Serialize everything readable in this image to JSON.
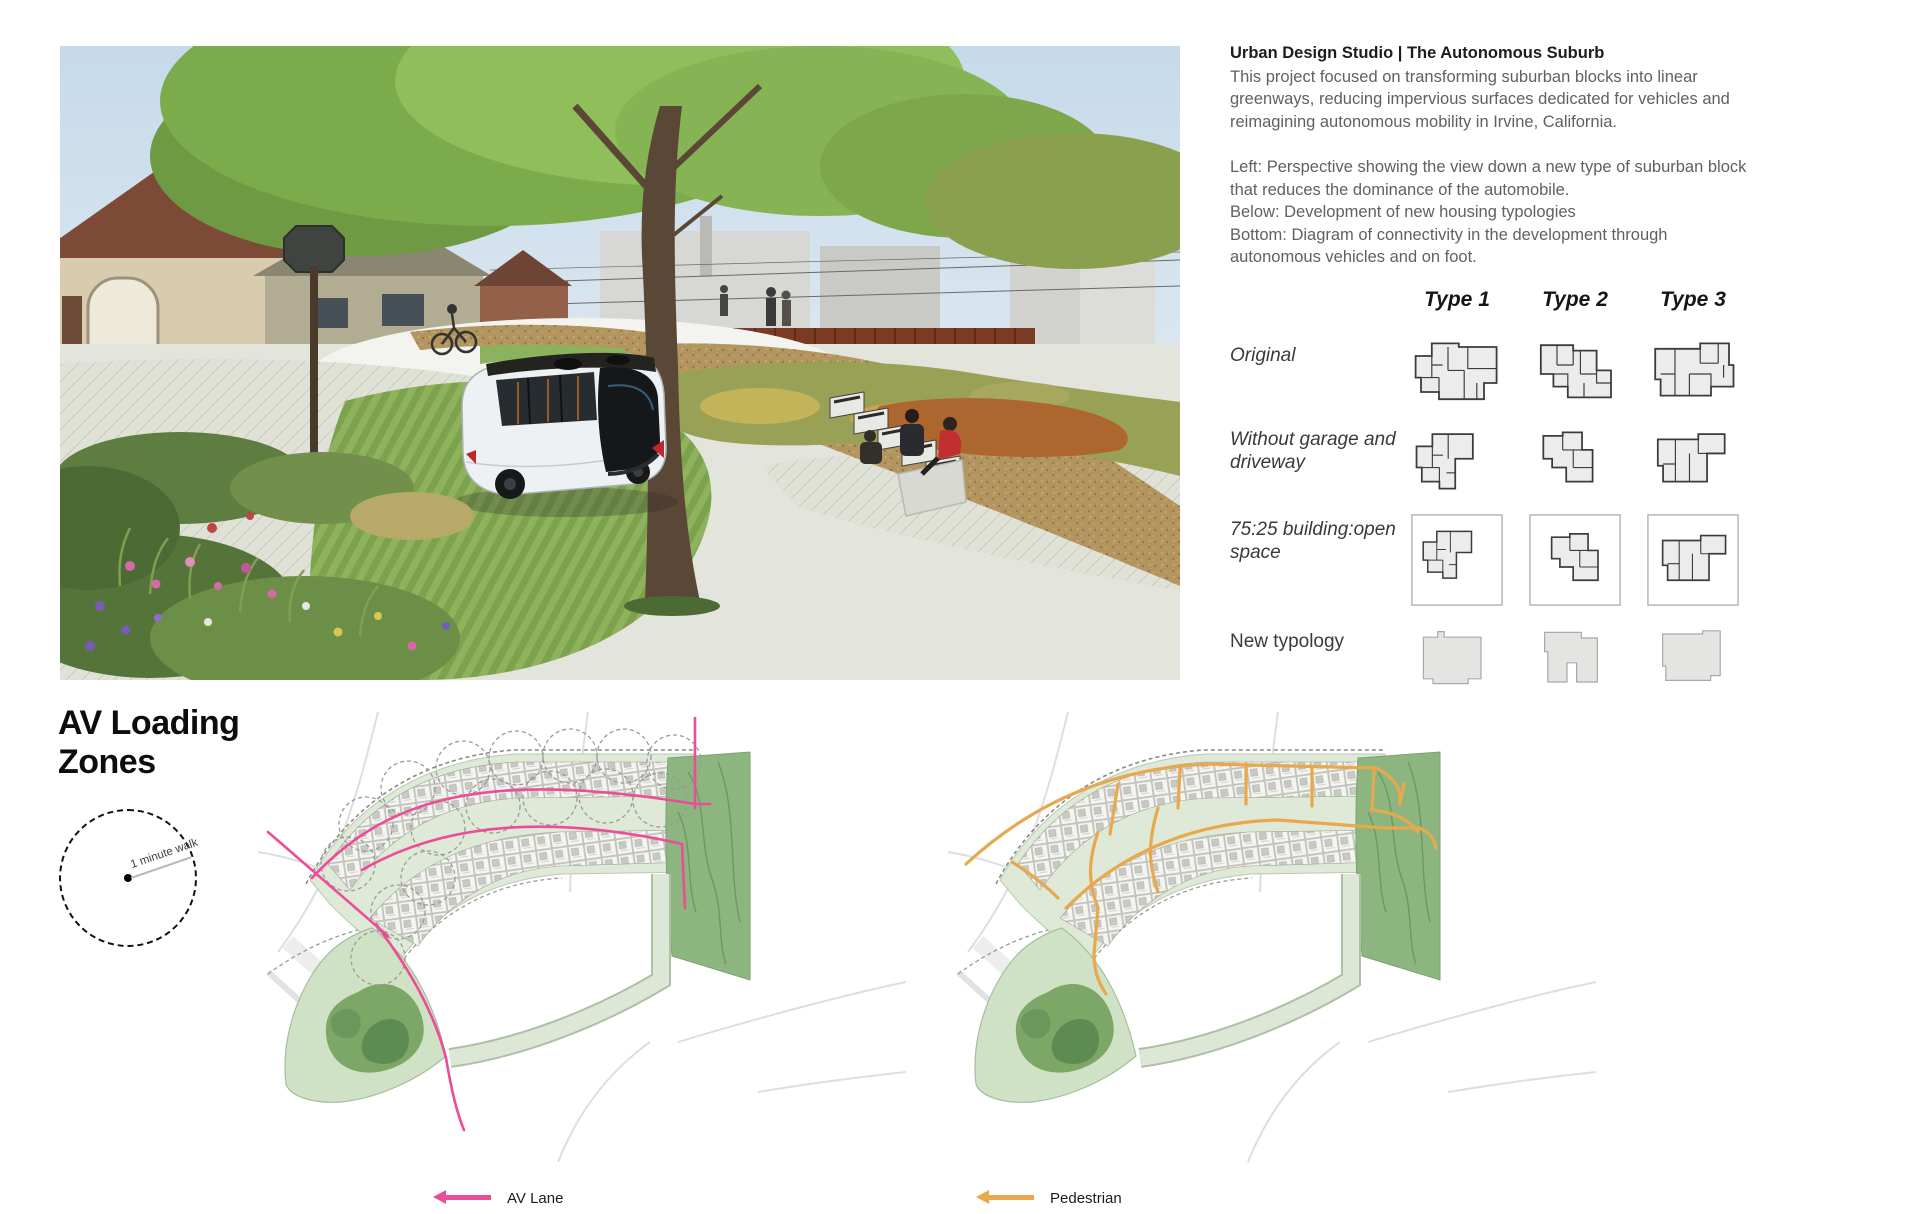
{
  "intro": {
    "title": "Urban Design Studio | The Autonomous Suburb",
    "description": "This project focused on transforming suburban blocks into linear greenways, reducing impervious surfaces dedicated for vehicles and reimagining autonomous mobility in Irvine, California.",
    "caption_left": "Left: Perspective showing the view down a new type of suburban block that reduces the dominance of the automobile.",
    "caption_below": "Below: Development of new housing typologies",
    "caption_bottom": "Bottom: Diagram of connectivity in the development through autonomous vehicles and on foot."
  },
  "typology_matrix": {
    "columns": [
      "Type 1",
      "Type 2",
      "Type 3"
    ],
    "rows": [
      "Original",
      "Without garage and driveway",
      "75:25 building:open space",
      "New typology"
    ]
  },
  "av_section": {
    "heading": "AV Loading Zones",
    "walk_radius_label": "1 minute walk"
  },
  "legend": {
    "av_lane": {
      "label": "AV Lane",
      "color": "#ec4d96"
    },
    "pedestrian": {
      "label": "Pedestrian",
      "color": "#e7a84e"
    }
  }
}
